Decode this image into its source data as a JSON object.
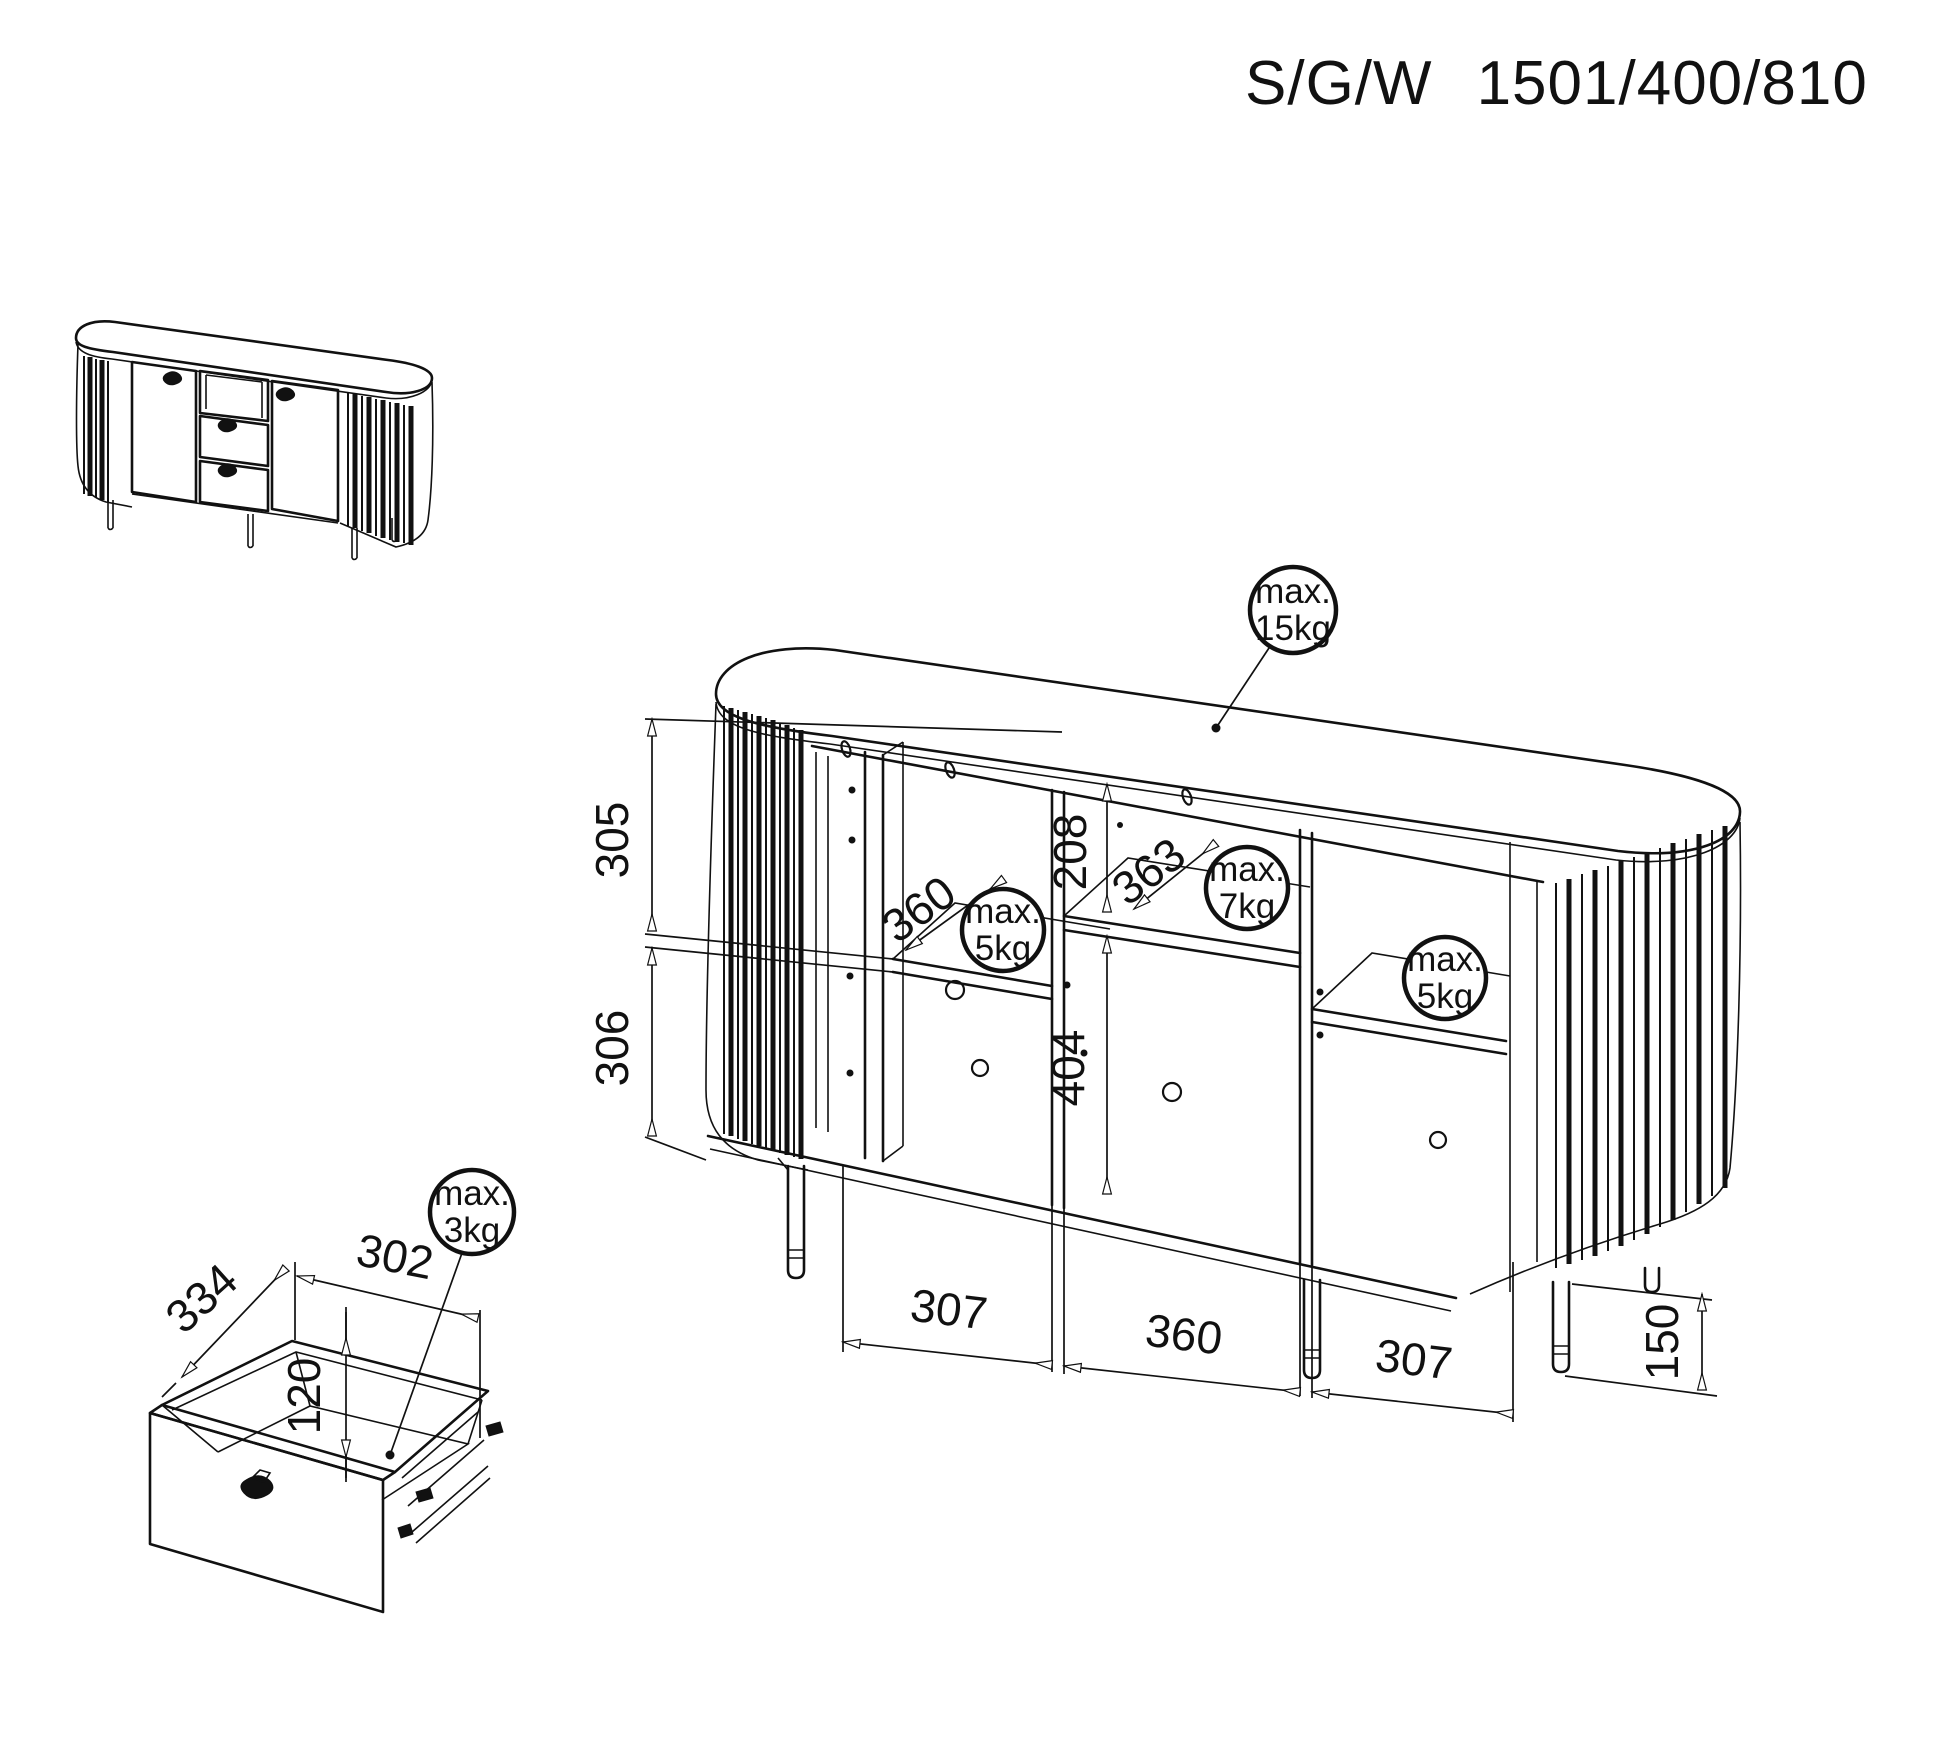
{
  "title": {
    "model": "S/G/W",
    "size": "1501/400/810"
  },
  "dims": {
    "left_upper": "305",
    "left_lower": "306",
    "middle_upper": "208",
    "middle_lower": "404",
    "left_shelf_depth": "360",
    "middle_shelf_depth": "363",
    "bottom_left": "307",
    "bottom_middle": "360",
    "bottom_right": "307",
    "leg_height": "150",
    "drawer_depth": "334",
    "drawer_width": "302",
    "drawer_height": "120"
  },
  "weights": {
    "top": {
      "l1": "max.",
      "l2": "15kg"
    },
    "left_shelf": {
      "l1": "max.",
      "l2": "5kg"
    },
    "middle_shelf": {
      "l1": "max.",
      "l2": "7kg"
    },
    "right_shelf": {
      "l1": "max.",
      "l2": "5kg"
    },
    "drawer": {
      "l1": "max.",
      "l2": "3kg"
    }
  }
}
